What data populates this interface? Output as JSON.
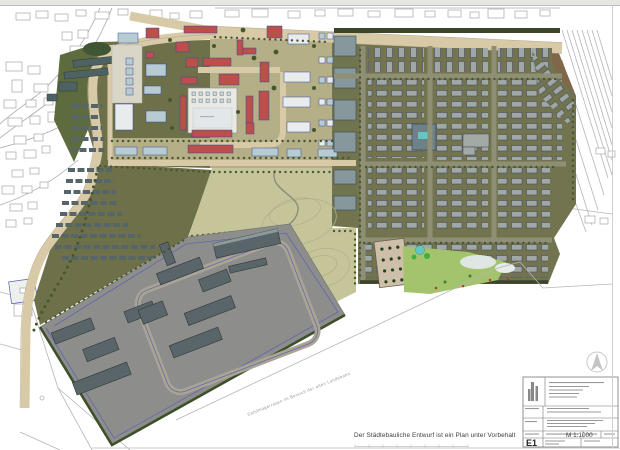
{
  "document": {
    "caption": "Der Städtebauliche Entwurf ist ein Plan unter Vorbehalt",
    "scale_label": "M 1:1000",
    "sheet_code": "E1",
    "site_note": "Sandmagerrasen im Bereich der alten Landebahn"
  },
  "palette": {
    "paper": "#ffffff",
    "sheet_edge": "#e6e6e3",
    "town_line": "#a8a8a4",
    "road_fill": "#d8caa6",
    "road_edge": "#b3a687",
    "khaki": "#b4af87",
    "olive_dark": "#6e7049",
    "park_fill": "#c6c59a",
    "park_contour": "#b2b188",
    "dist_ground": "#72744f",
    "dist_road": "#8f8f75",
    "tree_green": "#46572e",
    "hedge_dark": "#3a452a",
    "lawn_green": "#a3c46c",
    "pond_teal": "#62c6c3",
    "plaza_sand": "#cec0a8",
    "industrial_fill": "#8d8e8c",
    "industrial_bldg": "#5a6569",
    "nw_bldg": "#4e6263",
    "red_bldg": "#bb4f49",
    "teal_bldg": "#b7ccd2",
    "pale_bldg": "#e9ecec",
    "bldg_outline": "#3a4a9a",
    "boundary_blue": "#5a5fae",
    "line_gray": "#b5b5b5",
    "text_dark": "#3c3c3c",
    "text_faint": "#9a9a9a"
  }
}
